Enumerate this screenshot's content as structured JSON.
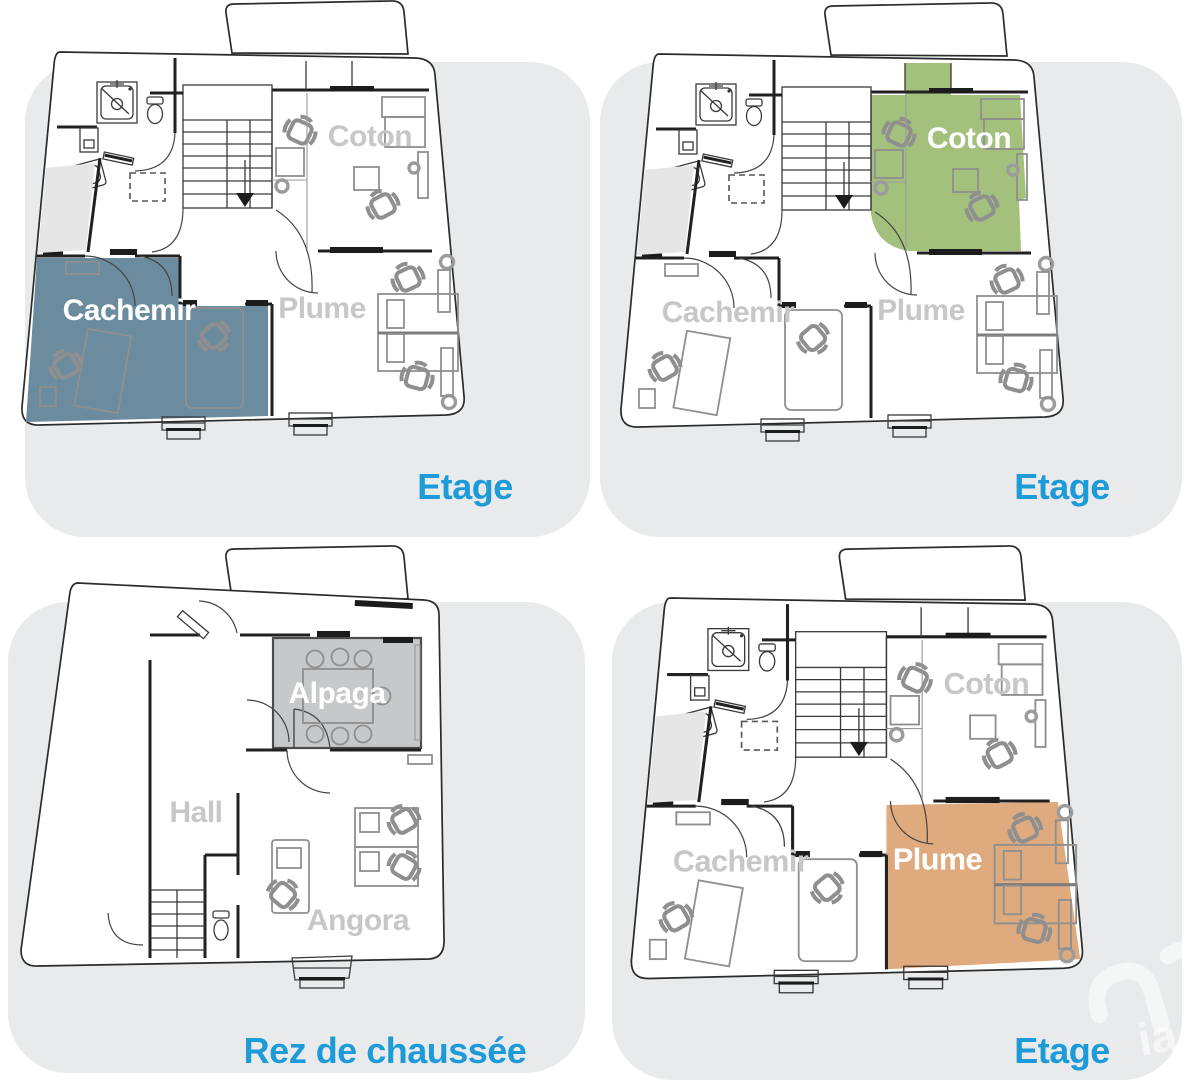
{
  "panels": [
    {
      "caption": "Etage",
      "highlight_room": "Cachemir",
      "rooms": {
        "cachemir": "Cachemir",
        "coton": "Coton",
        "plume": "Plume"
      }
    },
    {
      "caption": "Etage",
      "highlight_room": "Coton",
      "rooms": {
        "cachemir": "Cachemir",
        "coton": "Coton",
        "plume": "Plume"
      }
    },
    {
      "caption": "Rez de chaussée",
      "highlight_room": "Alpaga",
      "rooms": {
        "alpaga": "Alpaga",
        "hall": "Hall",
        "angora": "Angora"
      }
    },
    {
      "caption": "Etage",
      "highlight_room": "Plume",
      "rooms": {
        "cachemir": "Cachemir",
        "coton": "Coton",
        "plume": "Plume"
      }
    }
  ],
  "watermark": {
    "text": "ia"
  },
  "palette": {
    "caption-blue": "#1d9bd8",
    "room-label-gray": "#c7c7c8",
    "cachemir-fill": "#6b8c9e",
    "coton-fill": "#a3c17d",
    "plume-fill": "#dfab7e",
    "alpaga-fill": "#c7c8ca",
    "panel-bg": "#e9eaeb",
    "wall-ink": "#212121",
    "furniture-gray": "#8f8f8f"
  }
}
